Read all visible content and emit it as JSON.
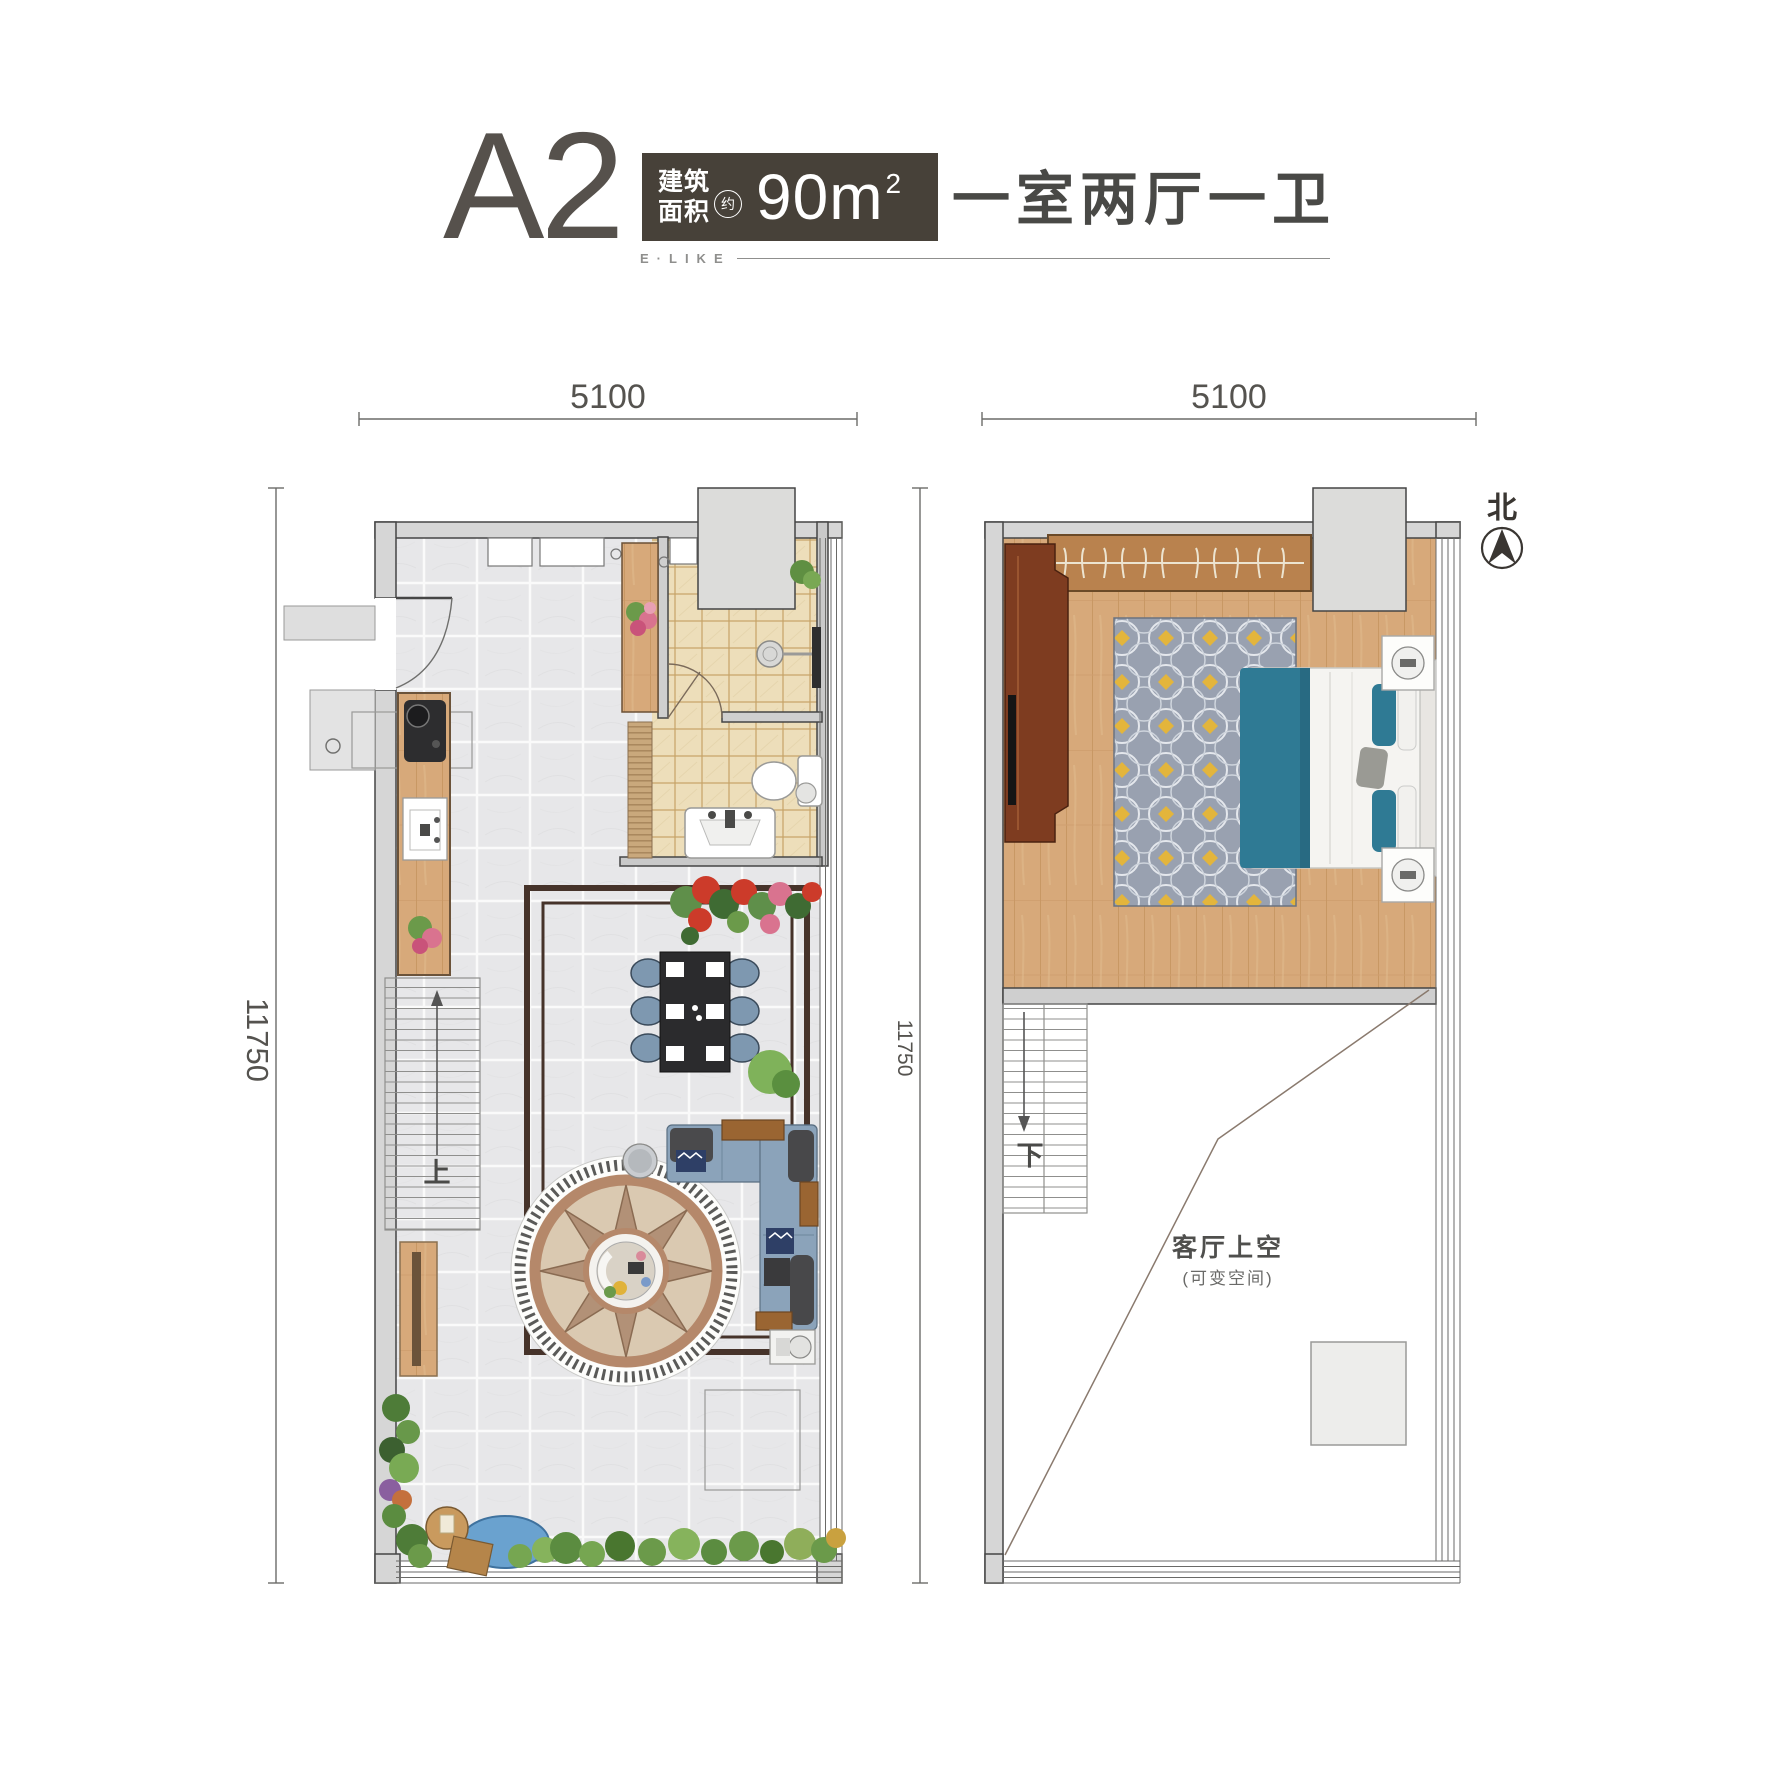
{
  "header": {
    "unit": "A2",
    "area": {
      "line1": "建筑",
      "line2": "面积",
      "approx": "约",
      "value": "90m",
      "exponent": "2"
    },
    "layout_desc": "一室两厅一卫",
    "brand": "E·LIKE"
  },
  "dimensions": {
    "floor1": {
      "width": "5100",
      "height": "11750"
    },
    "floor2": {
      "width": "5100",
      "height": "11750"
    }
  },
  "compass": {
    "north_label": "北"
  },
  "floor1": {
    "stair_direction": "上"
  },
  "floor2": {
    "stair_direction": "下",
    "void_title": "客厅上空",
    "void_subtitle": "(可变空间)"
  },
  "colors": {
    "title_box_bg": "#474139",
    "title_text": "#56514c",
    "wall_fill": "#d6d6d6",
    "wall_edge": "#454545",
    "tile_gray": "#e7e7e9",
    "tile_beige": "#eddeba",
    "wood_floor": "#d7a97a",
    "wardrobe_wood": "#b9824e",
    "cabinet_wood": "#7e3c20",
    "sofa_blue": "#8ba3ba",
    "bed_teal": "#2f7a94",
    "rug_gray": "#99a1b0",
    "rug_yellow": "#e3b53c",
    "medallion_brown": "#b5886a",
    "garden_green": "#5f8f42",
    "dimension_text": "#55534f"
  }
}
